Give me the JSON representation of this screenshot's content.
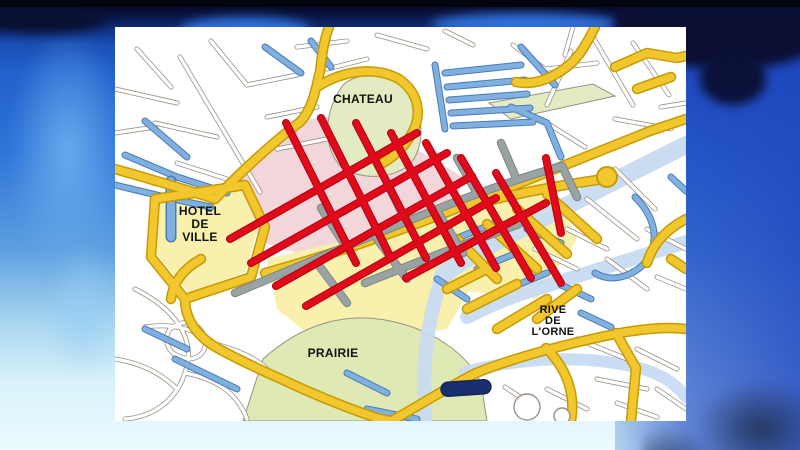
{
  "map": {
    "labels": {
      "chateau": "CHATEAU",
      "hotel_de_ville": [
        "HOTEL",
        "DE",
        "VILLE"
      ],
      "prairie": "PRAIRIE",
      "rive_de_lorne": [
        "RIVE",
        "DE",
        "L'ORNE"
      ]
    },
    "colors": {
      "map_background": "#FFFFFF",
      "road_yellow": "#F2C72E",
      "road_yellow_edge": "#C49B05",
      "road_red": "#E00A1A",
      "road_red_edge": "#B00012",
      "road_blue": "#7FB0E0",
      "road_blue_edge": "#4A7AB8",
      "road_gray": "#9AA3A3",
      "road_gray_edge": "#7D8585",
      "road_white": "#FFFFFF",
      "street_outline": "#9A9185",
      "district_pink": "#F2D6DA",
      "district_pale_yellow": "#F8F0AC",
      "park_green": "#E3EBC3",
      "prairie_green": "#DFE9B4",
      "river_blue": "#C9DCF2",
      "pond_navy": "#1B2F6E",
      "label_black": "#111111"
    }
  },
  "backdrop": {
    "colors": {
      "top_bar": "#04040F",
      "deep_navy": "#0A1240",
      "royal_blue": "#2E74D8",
      "fade_cyan": "#EAFBFF"
    }
  }
}
